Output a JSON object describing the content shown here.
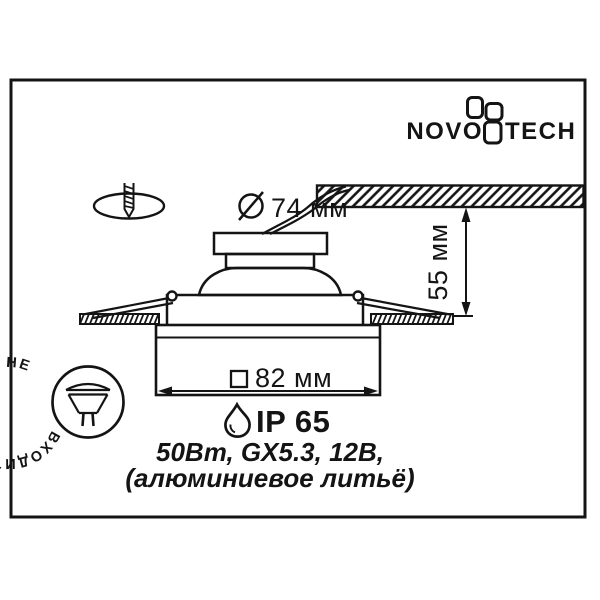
{
  "brand": {
    "name": "NOVOTECH",
    "left": "NOVO",
    "right": "TECH"
  },
  "dimensions": {
    "cutout_diameter": "74 мм",
    "recess_height": "55 мм",
    "trim_width": "82 мм"
  },
  "rating": {
    "ip": "IP 65"
  },
  "specs": {
    "line1": "50Вт, GX5.3, 12В,",
    "line2": "(алюминиевое литьё)"
  },
  "stamp": {
    "text": "НЕ ВХОДИТ В КОМПЛЕКТ"
  },
  "icons": {
    "drill": "drill-icon",
    "diameter": "diameter-icon",
    "square": "square-symbol-icon",
    "water_drop": "water-drop-icon",
    "lamp": "mr16-lamp-icon",
    "logo_mark": "novotech-pinwheel-mark"
  },
  "colors": {
    "ink": "#141414",
    "background": "#ffffff"
  }
}
